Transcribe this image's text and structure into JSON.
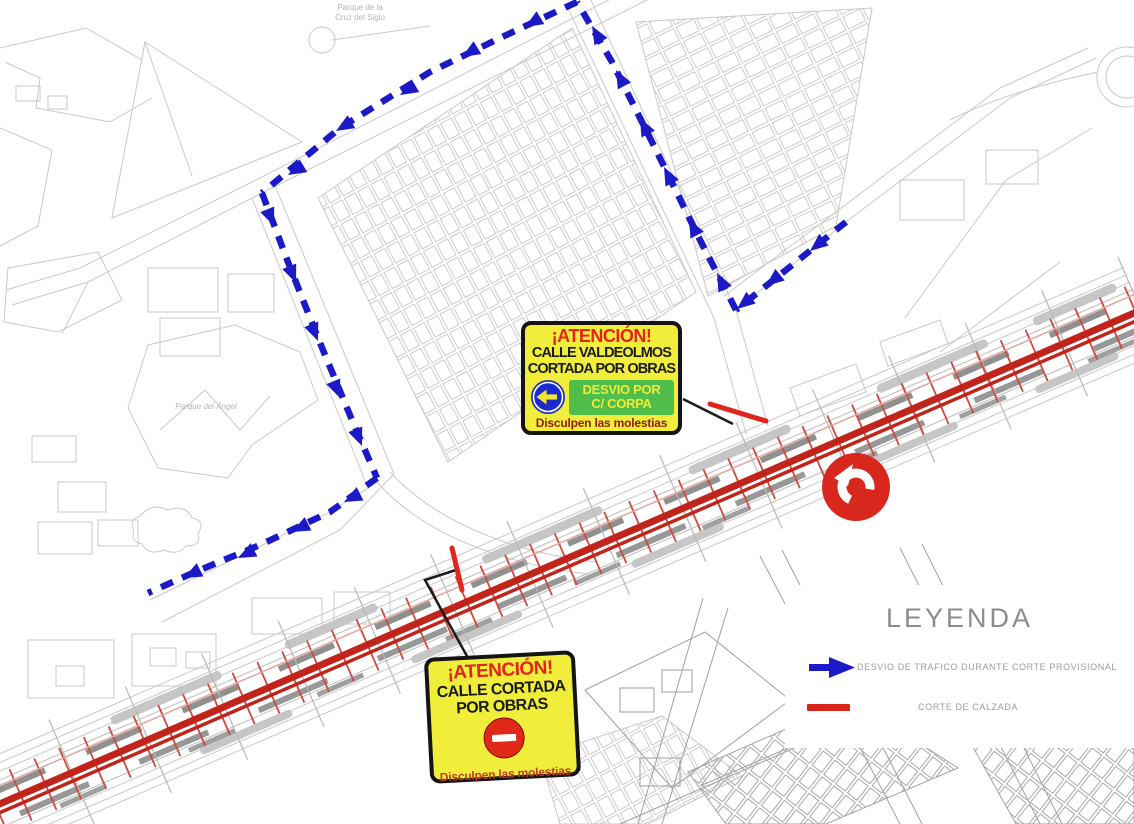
{
  "signs": {
    "valdeolmos": {
      "attention": "¡ATENCIÓN!",
      "line1": "CALLE VALDEOLMOS",
      "line2": "CORTADA POR OBRAS",
      "detour_line1": "DESVIO POR",
      "detour_line2": "C/ CORPA",
      "apology": "Disculpen las molestias"
    },
    "cortada": {
      "attention": "¡ATENCIÓN!",
      "line1": "CALLE CORTADA",
      "line2": "POR OBRAS",
      "apology": "Disculpen las molestias"
    }
  },
  "legend": {
    "title": "LEYENDA",
    "items": [
      {
        "symbol": "blue-arrow",
        "label": "DESVIO DE TRAFICO DURANTE CORTE PROVISIONAL",
        "color": "#1c1ac6"
      },
      {
        "symbol": "red-line",
        "label": "CORTE DE CALZADA",
        "color": "#d8281e"
      }
    ]
  },
  "map_labels": {
    "park_top_line1": "Parque de la",
    "park_top_line2": "Cruz del Siglo",
    "park_left": "Parque del Ángel"
  },
  "colors": {
    "diversion_blue": "#1c1ac6",
    "closure_red": "#e0261c",
    "corridor_red": "#c1241a",
    "sign_yellow": "#f1ee3b",
    "sign_green": "#4fbe4a",
    "mandatory_blue": "#1b2acc",
    "attention_red": "#e3241a"
  }
}
